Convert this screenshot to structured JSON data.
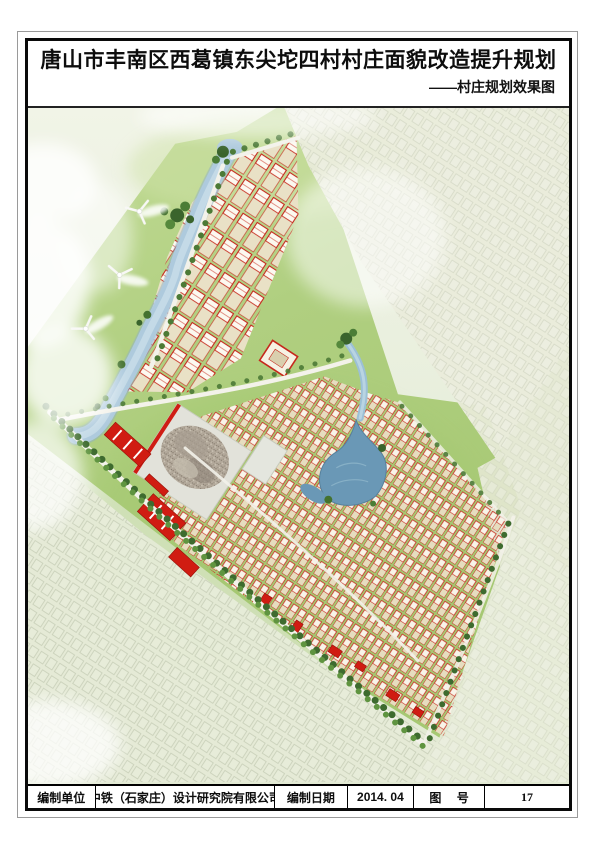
{
  "document": {
    "title": "唐山市丰南区西葛镇东尖坨四村村庄面貌改造提升规划",
    "subtitle": "——村庄规划效果图"
  },
  "footer": {
    "cells": [
      "编制单位",
      "中铁（石家庄）设计研究院有限公司",
      "编制日期",
      "2014. 04",
      "图 号",
      "17"
    ]
  },
  "rendering": {
    "caption": "村庄规划效果图",
    "colors": {
      "grass": "#aecb7d",
      "faded_existing_village": "#e9ecda",
      "river": "#aecadd",
      "pond": "#6a98b6",
      "house_outline_red": "#c6281c",
      "public_building_red": "#d01c12",
      "road": "#f3f2ea",
      "tree_dark_green": "#3e6b2f",
      "construction_gray": "#b3a99b"
    }
  }
}
